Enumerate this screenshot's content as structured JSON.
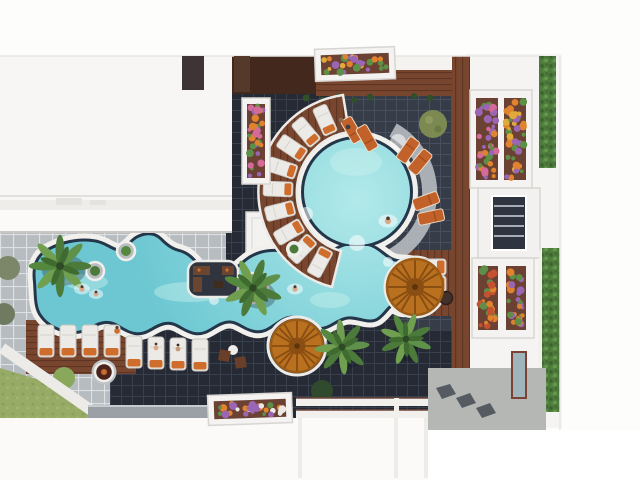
{
  "scene": {
    "title": "Aerial top-down 3D rendering of a resort courtyard with a freeform turquoise lagoon pool, wavy white coping, dark graphite paving, wooden sun decks, palm trees, thatched umbrellas and white apartment roofs",
    "view": "top-down aerial",
    "style": "photorealistic CGI architectural render",
    "time_of_day": "daytime",
    "areas": {
      "pool": "freeform lazy-river pool with circular lagoon section, dark rim and white wavy coping",
      "paving": "dark graphite tile courtyard with light concrete ring walkway",
      "decks": "reddish hardwood sun decks",
      "landscape": "palms, round hedges, lawn corner, flower planters",
      "buildings": "white flat-roofed blocks on left, right and bottom edges"
    },
    "objects": {
      "pools": 1,
      "thatched_umbrellas": 2,
      "palm_trees": 4,
      "sun_loungers": 25,
      "flower_planters": 7,
      "hedge_strips": 2,
      "people": 9,
      "round_side_tables": 3,
      "fire_bowl": 1,
      "seating_peninsula": 1
    }
  },
  "palette": {
    "water": "#8fd9de",
    "water_light": "#cdf2ef",
    "pool_rim": "#23364a",
    "coping": "#f1f0ec",
    "pave_dark": "#252a34",
    "pave_grid": "#39404d",
    "tile_light": "#b7bcc0",
    "tile_grout": "#dde1e3",
    "wood": "#78452f",
    "wood_dark": "#5e3423",
    "umbrella": "#b9701f",
    "umbrella_rib": "#8a4e12",
    "lounger_white": "#eceae6",
    "cushion_orange": "#cf6d2c",
    "grass": "#97ab66",
    "hedge": "#4e7a3c",
    "palm_leaf": "#4c7a3a",
    "palm_leaf_light": "#6f9f4f",
    "roof_white": "#f7f6f4",
    "skin": "#d9a98a",
    "flowers": {
      "orange": "#e0832f",
      "purple": "#9a66b4",
      "green": "#5d8f46",
      "pink": "#d56a9a",
      "yellow": "#e2aa3a",
      "white": "#ece8e2",
      "red": "#c4512f"
    }
  }
}
